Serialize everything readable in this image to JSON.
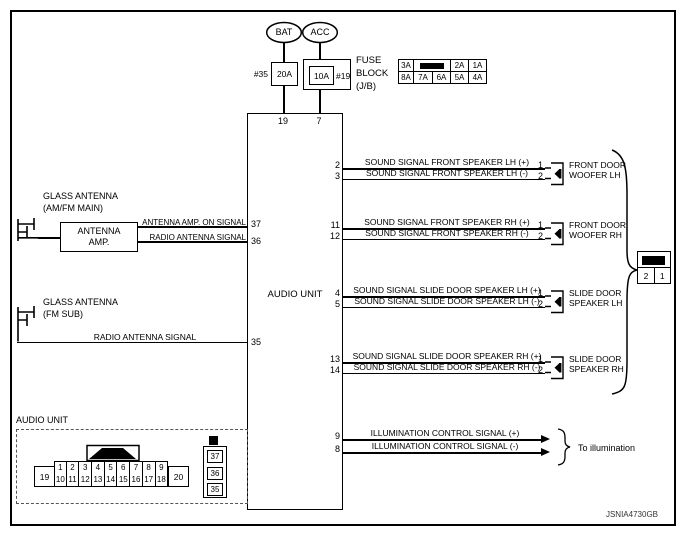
{
  "footer": {
    "code": "JSNIA4730GB"
  },
  "power": {
    "bat": "BAT",
    "acc": "ACC",
    "fuse_bat_ref": "#35",
    "fuse_bat_amp": "20A",
    "fuse_acc_amp": "10A",
    "fuse_acc_ref": "#19",
    "fuse_block_label": [
      "FUSE",
      "BLOCK",
      "(J/B)"
    ],
    "pin_bat": "19",
    "pin_acc": "7"
  },
  "fuse_table": {
    "row1": [
      "3A",
      "2A",
      "1A"
    ],
    "row2": [
      "8A",
      "7A",
      "6A",
      "5A",
      "4A"
    ]
  },
  "audio_unit": {
    "label": "AUDIO UNIT"
  },
  "antenna_main": {
    "title": [
      "GLASS ANTENNA",
      "(AM/FM MAIN)"
    ],
    "amp": [
      "ANTENNA",
      "AMP."
    ],
    "sig_on": "ANTENNA AMP. ON SIGNAL",
    "sig_radio": "RADIO ANTENNA SIGNAL",
    "pin_on": "37",
    "pin_radio": "36"
  },
  "antenna_sub": {
    "title": [
      "GLASS ANTENNA",
      "(FM SUB)"
    ],
    "sig": "RADIO ANTENNA SIGNAL",
    "pin": "35"
  },
  "speaker_groups": [
    {
      "pin_plus": "2",
      "pin_minus": "3",
      "sig_plus": "SOUND SIGNAL FRONT SPEAKER LH (+)",
      "sig_minus": "SOUND SIGNAL FRONT SPEAKER LH (-)",
      "dpin1": "1",
      "dpin2": "2",
      "name1": "FRONT DOOR",
      "name2": "WOOFER LH"
    },
    {
      "pin_plus": "11",
      "pin_minus": "12",
      "sig_plus": "SOUND SIGNAL FRONT SPEAKER RH (+)",
      "sig_minus": "SOUND SIGNAL FRONT SPEAKER RH (-)",
      "dpin1": "1",
      "dpin2": "2",
      "name1": "FRONT DOOR",
      "name2": "WOOFER RH"
    },
    {
      "pin_plus": "4",
      "pin_minus": "5",
      "sig_plus": "SOUND SIGNAL SLIDE DOOR SPEAKER LH (+)",
      "sig_minus": "SOUND SIGNAL SLIDE DOOR SPEAKER LH (-)",
      "dpin1": "1",
      "dpin2": "2",
      "name1": "SLIDE DOOR",
      "name2": "SPEAKER LH"
    },
    {
      "pin_plus": "13",
      "pin_minus": "14",
      "sig_plus": "SOUND SIGNAL SLIDE DOOR SPEAKER RH (+)",
      "sig_minus": "SOUND SIGNAL SLIDE DOOR SPEAKER RH (-)",
      "dpin1": "1",
      "dpin2": "2",
      "name1": "SLIDE DOOR",
      "name2": "SPEAKER RH"
    }
  ],
  "illumination": {
    "pin_plus": "9",
    "pin_minus": "8",
    "sig_plus": "ILLUMINATION CONTROL SIGNAL (+)",
    "sig_minus": "ILLUMINATION CONTROL SIGNAL (-)",
    "dest": "To illumination"
  },
  "door_connector": {
    "pins": [
      "2",
      "1"
    ]
  },
  "unit_connector": {
    "title": "AUDIO UNIT",
    "pin_left": "19",
    "pin_right": "20",
    "row_top": [
      "1",
      "2",
      "3",
      "4",
      "5",
      "6",
      "7",
      "8",
      "9"
    ],
    "row_bottom": [
      "10",
      "11",
      "12",
      "13",
      "14",
      "15",
      "16",
      "17",
      "18"
    ],
    "side_pins": [
      "37",
      "36",
      "35"
    ]
  }
}
